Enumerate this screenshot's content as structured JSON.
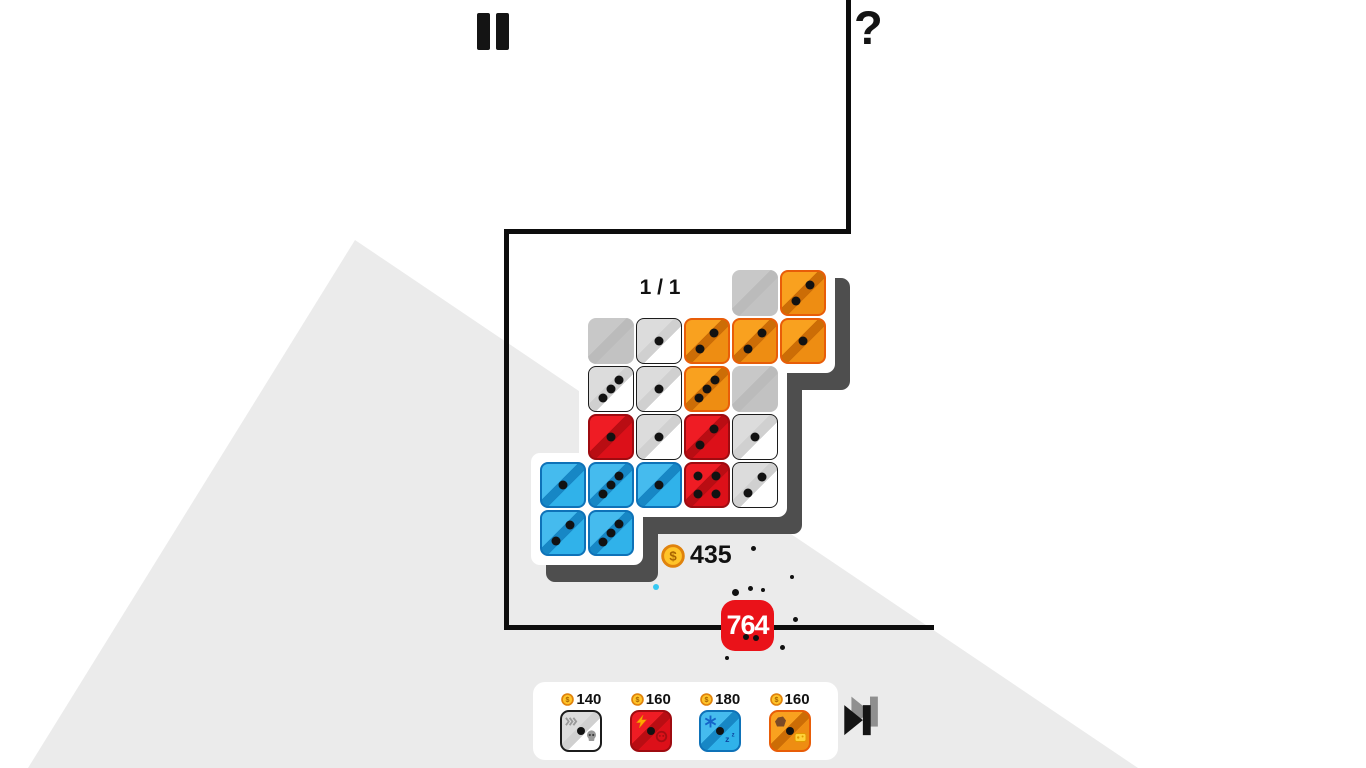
{
  "hud": {
    "help_label": "?",
    "coin_count": "435",
    "damage_value": "764"
  },
  "board": {
    "progress_label": "1 / 1",
    "grid": {
      "origin_x": 540,
      "origin_y": 270,
      "pitch": 48,
      "tile": 46
    },
    "tiles": [
      {
        "row": 0,
        "col": 4,
        "color": "gray",
        "pips": 0
      },
      {
        "row": 0,
        "col": 5,
        "color": "orange",
        "pips": 2
      },
      {
        "row": 1,
        "col": 1,
        "color": "gray",
        "pips": 0
      },
      {
        "row": 1,
        "col": 2,
        "color": "white",
        "pips": 1
      },
      {
        "row": 1,
        "col": 3,
        "color": "orange",
        "pips": 2
      },
      {
        "row": 1,
        "col": 4,
        "color": "orange",
        "pips": 2
      },
      {
        "row": 1,
        "col": 5,
        "color": "orange",
        "pips": 1
      },
      {
        "row": 2,
        "col": 1,
        "color": "white",
        "pips": 3
      },
      {
        "row": 2,
        "col": 2,
        "color": "white",
        "pips": 1
      },
      {
        "row": 2,
        "col": 3,
        "color": "orange",
        "pips": 3
      },
      {
        "row": 2,
        "col": 4,
        "color": "gray",
        "pips": 0
      },
      {
        "row": 3,
        "col": 1,
        "color": "red",
        "pips": 1
      },
      {
        "row": 3,
        "col": 2,
        "color": "white",
        "pips": 1
      },
      {
        "row": 3,
        "col": 3,
        "color": "red",
        "pips": 2
      },
      {
        "row": 3,
        "col": 4,
        "color": "white",
        "pips": 1
      },
      {
        "row": 4,
        "col": 0,
        "color": "blue",
        "pips": 1
      },
      {
        "row": 4,
        "col": 1,
        "color": "blue",
        "pips": 3
      },
      {
        "row": 4,
        "col": 2,
        "color": "blue",
        "pips": 1
      },
      {
        "row": 4,
        "col": 3,
        "color": "red",
        "pips": 4
      },
      {
        "row": 4,
        "col": 4,
        "color": "white",
        "pips": 2
      },
      {
        "row": 5,
        "col": 0,
        "color": "blue",
        "pips": 2
      },
      {
        "row": 5,
        "col": 1,
        "color": "blue",
        "pips": 3
      }
    ]
  },
  "shop": {
    "items": [
      {
        "price": "140",
        "color": "white",
        "top_icon": "fast-forward-icon",
        "bottom_icon": "skull-icon"
      },
      {
        "price": "160",
        "color": "red",
        "top_icon": "lightning-icon",
        "bottom_icon": "dizzy-icon"
      },
      {
        "price": "180",
        "color": "blue",
        "top_icon": "snowflake-icon",
        "bottom_icon": "sleep-icon"
      },
      {
        "price": "160",
        "color": "orange",
        "top_icon": "rock-icon",
        "bottom_icon": "cheese-icon"
      }
    ]
  },
  "particles": [
    {
      "x": 753,
      "y": 548,
      "r": 2.5,
      "color": "#111111"
    },
    {
      "x": 792,
      "y": 577,
      "r": 2,
      "color": "#111111"
    },
    {
      "x": 750,
      "y": 588,
      "r": 2.5,
      "color": "#111111"
    },
    {
      "x": 763,
      "y": 590,
      "r": 2,
      "color": "#111111"
    },
    {
      "x": 735,
      "y": 592,
      "r": 3.5,
      "color": "#111111"
    },
    {
      "x": 795,
      "y": 619,
      "r": 2.5,
      "color": "#111111"
    },
    {
      "x": 746,
      "y": 637,
      "r": 3,
      "color": "#111111"
    },
    {
      "x": 756,
      "y": 638,
      "r": 3,
      "color": "#111111"
    },
    {
      "x": 782,
      "y": 647,
      "r": 2.5,
      "color": "#111111"
    },
    {
      "x": 727,
      "y": 658,
      "r": 2,
      "color": "#111111"
    },
    {
      "x": 656,
      "y": 587,
      "r": 3.2,
      "color": "#35C8F2"
    }
  ],
  "colors": {
    "background_triangle": "#EBEBEB",
    "tray_shadow": "#4E4E4E",
    "tray": "#FFFFFF",
    "boundary_line": "#0D0D0D",
    "badge_red": "#EA1219",
    "coin_fill": "#FFC429",
    "coin_ring": "#E0830D",
    "tiles": {
      "orange": {
        "a": "#F9A11F",
        "band": "#CC6D06",
        "b": "#EE8D12",
        "border": "#E85D08"
      },
      "red": {
        "a": "#EF1C24",
        "band": "#B90D13",
        "b": "#DC1019",
        "border": "#9E0B10"
      },
      "blue": {
        "a": "#45BBEE",
        "band": "#1787C5",
        "b": "#30B2EA",
        "border": "#0E72B8"
      },
      "white": {
        "a": "#DCDCDC",
        "band": "#D0D0D0",
        "b": "#FFFFFF",
        "border": "#1C1C1C"
      },
      "gray": {
        "a": "#C8C8C8",
        "band": "#BBBBBB",
        "b": "#C2C2C2",
        "border": "transparent"
      }
    }
  }
}
